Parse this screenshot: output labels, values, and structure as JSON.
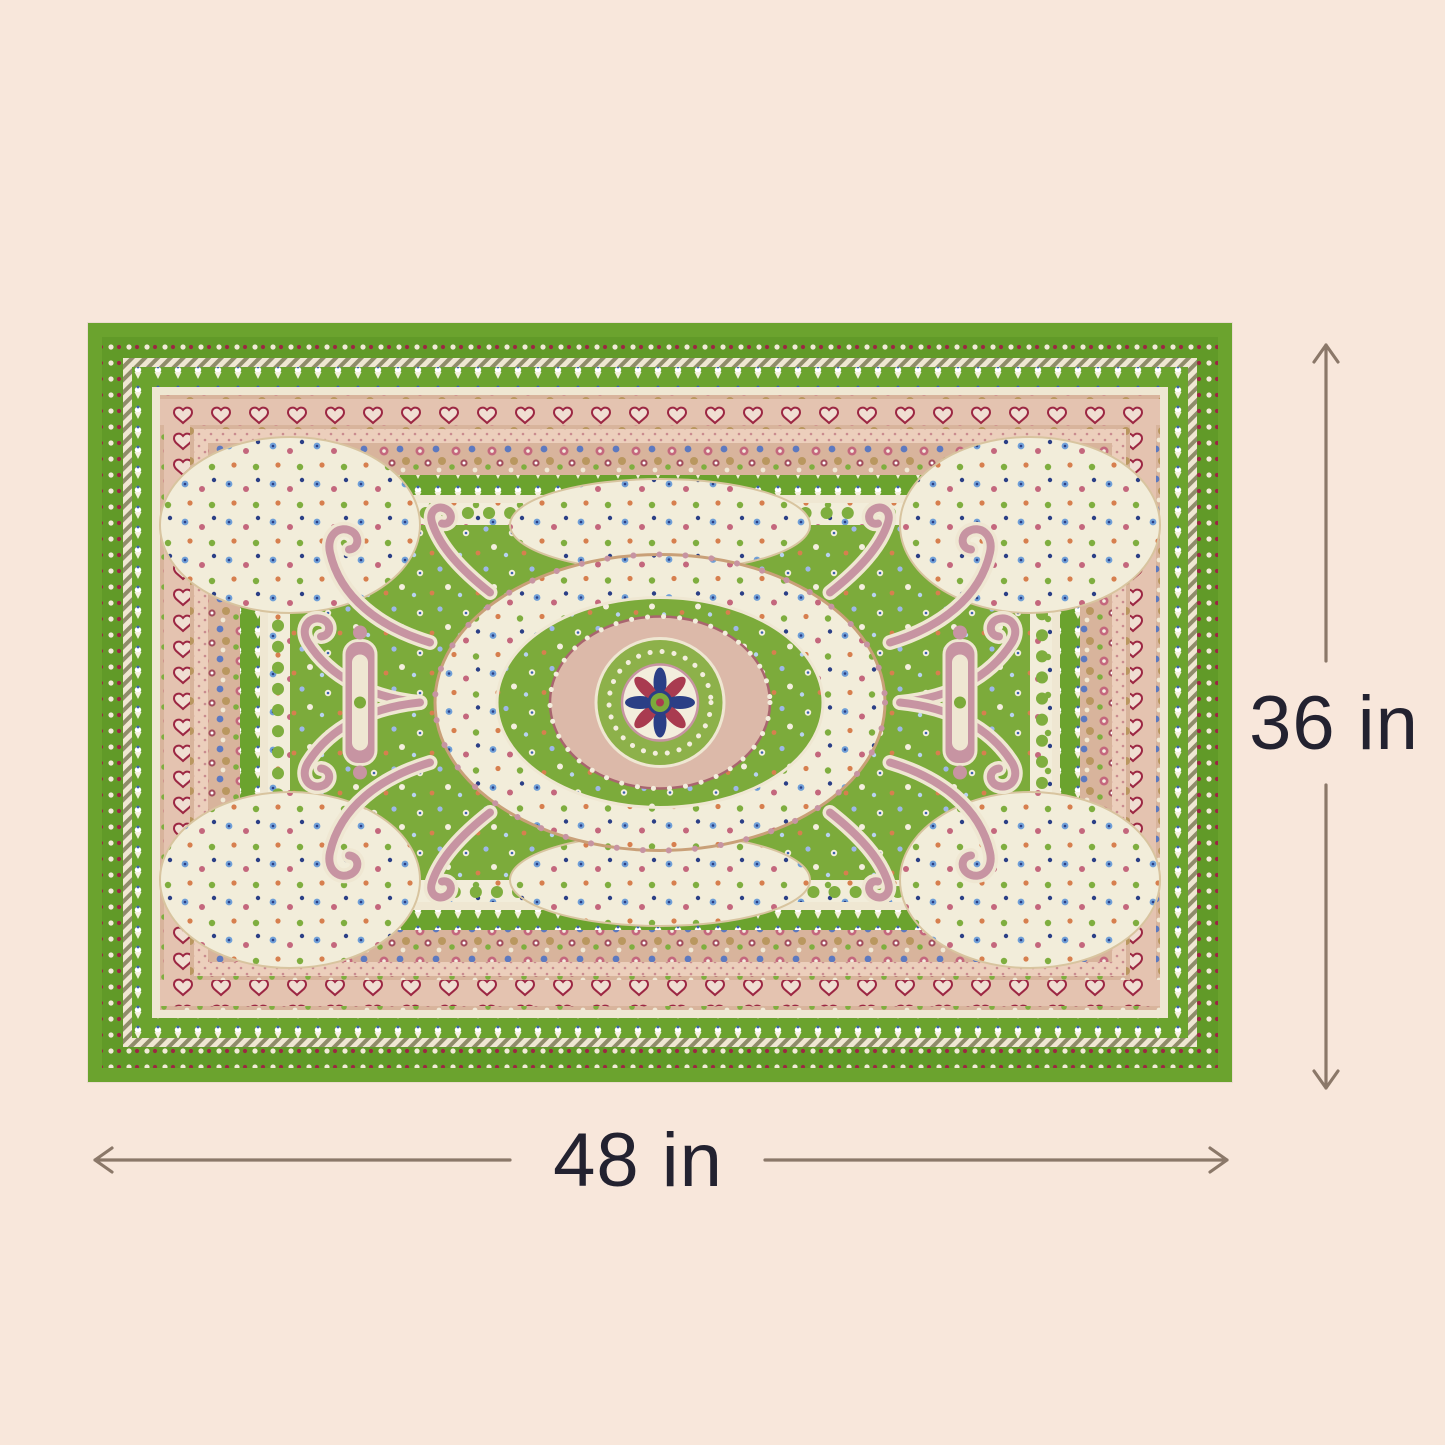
{
  "dimensions": {
    "height_label": "36 in",
    "width_label": "48 in"
  },
  "icons": {
    "height_arrow": "double-headed-vertical-arrow",
    "width_arrow": "double-headed-horizontal-arrow"
  },
  "colors": {
    "background": "#f8e7db",
    "arrow": "#8b7869",
    "ink": "#232230",
    "rug_border_green": "#6ba32e",
    "rug_field_green": "#7cab3b",
    "rug_cream": "#f2edda",
    "rug_pink_band": "#e4c3b0",
    "rug_tan": "#c9a078",
    "rug_rose": "#c794a2",
    "rug_red": "#a93b50",
    "rug_blue": "#3a62b0"
  }
}
